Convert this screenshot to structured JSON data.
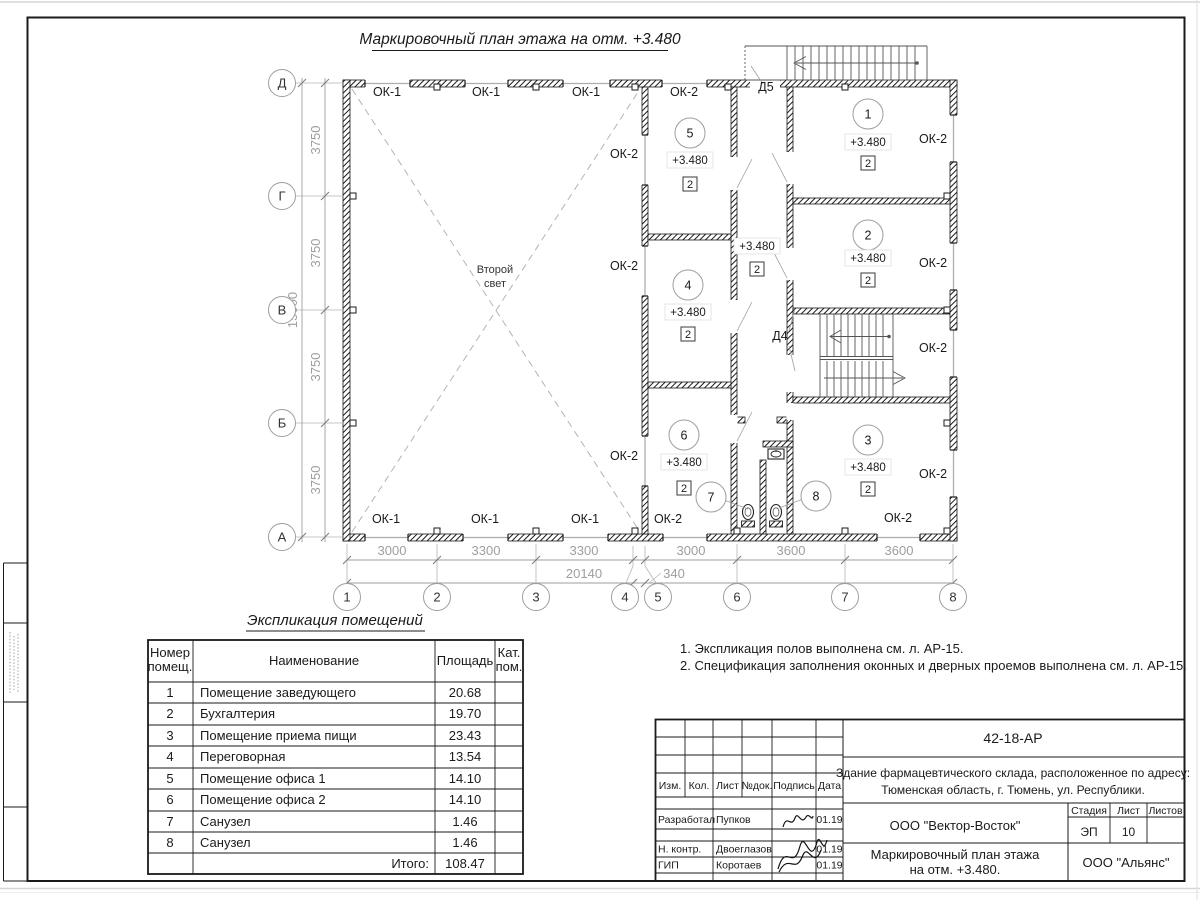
{
  "style": {
    "ink": "#1a1a1a",
    "dim_gray": "#9e9e9e",
    "glazing_gray": "#adadad",
    "paper": "#ffffff"
  },
  "plan": {
    "title": "Маркировочный план этажа на отм. +3.480",
    "second_light": [
      "Второй",
      "свет"
    ],
    "axis_rows": [
      "Д",
      "Г",
      "В",
      "Б",
      "А"
    ],
    "axis_cols": [
      "1",
      "2",
      "3",
      "4",
      "5",
      "6",
      "7",
      "8"
    ],
    "dims_left": [
      "3750",
      "3750",
      "3750",
      "3750"
    ],
    "dim_left_total": "15000",
    "dims_bottom": [
      "3000",
      "3300",
      "3300",
      "3000",
      "3600",
      "3600"
    ],
    "dim_bottom_offset": "340",
    "dim_bottom_total": "20140",
    "window_type_1": "ОК-1",
    "window_type_2": "ОК-2",
    "door_5": "Д5",
    "door_4": "Д4",
    "elevation": "+3.480",
    "category": "2",
    "room_numbers": [
      "1",
      "2",
      "3",
      "4",
      "5",
      "6",
      "7",
      "8"
    ]
  },
  "explication": {
    "title": "Экспликация помещений",
    "col_num": [
      "Номер",
      "помещ."
    ],
    "col_name": "Наименование",
    "col_area": "Площадь",
    "col_cat": [
      "Кат.",
      "пом."
    ],
    "rows": [
      {
        "num": "1",
        "name": "Помещение заведующего",
        "area": "20.68"
      },
      {
        "num": "2",
        "name": "Бухгалтерия",
        "area": "19.70"
      },
      {
        "num": "3",
        "name": "Помещение приема пищи",
        "area": "23.43"
      },
      {
        "num": "4",
        "name": "Переговорная",
        "area": "13.54"
      },
      {
        "num": "5",
        "name": "Помещение офиса 1",
        "area": "14.10"
      },
      {
        "num": "6",
        "name": "Помещение офиса 2",
        "area": "14.10"
      },
      {
        "num": "7",
        "name": "Санузел",
        "area": "1.46"
      },
      {
        "num": "8",
        "name": "Санузел",
        "area": "1.46"
      }
    ],
    "total_label": "Итого:",
    "total_value": "108.47"
  },
  "notes": [
    "1. Экспликация полов выполнена см. л. АР-15.",
    "2. Спецификация заполнения оконных и дверных проемов выполнена см. л. АР-15."
  ],
  "title_block": {
    "doc_code": "42-18-АР",
    "object_address": [
      "Здание фармацевтического склада, расположенное по адресу:",
      "Тюменская область, г. Тюмень, ул. Республики."
    ],
    "rev_headers": [
      "Изм.",
      "Кол.",
      "Лист",
      "№док.",
      "Подпись",
      "Дата"
    ],
    "signers": [
      {
        "role": "Разработал",
        "name": "Пупков",
        "date": "01.19"
      },
      {
        "role": "Н. контр.",
        "name": "Двоеглазов",
        "date": "01.19"
      },
      {
        "role": "ГИП",
        "name": "Коротаев",
        "date": "01.19"
      }
    ],
    "company": "ООО \"Вектор-Восток\"",
    "stage_label": "Стадия",
    "sheet_label": "Лист",
    "sheets_label": "Листов",
    "stage": "ЭП",
    "sheet_number": "10",
    "drawing_name": [
      "Маркировочный план этажа",
      "на отм. +3.480."
    ],
    "firm": "ООО \"Альянс\""
  }
}
